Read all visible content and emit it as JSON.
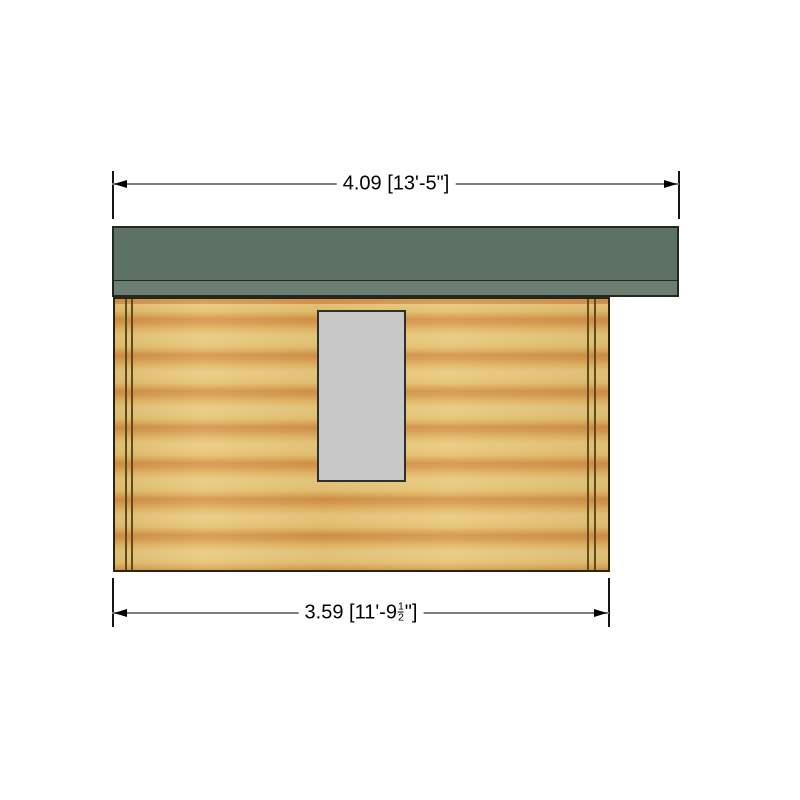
{
  "dimensions": {
    "top": {
      "label": "4.09 [13'-5\"]",
      "metric_m": "4.09",
      "imperial": "13'-5\""
    },
    "bottom": {
      "prefix": "3.59 [11'-9",
      "frac_num": "1",
      "frac_den": "2",
      "suffix": "\"]",
      "metric_m": "3.59"
    }
  },
  "colors": {
    "roof_main": "#5e7165",
    "roof_fascia": "#6b7e71",
    "wall_base": "#e6c478",
    "wall_band": "#d3914a",
    "window_fill": "#c8c8c8",
    "outline": "#222a20",
    "dimension_line": "#7d7d7d",
    "extension_line": "#161616"
  }
}
